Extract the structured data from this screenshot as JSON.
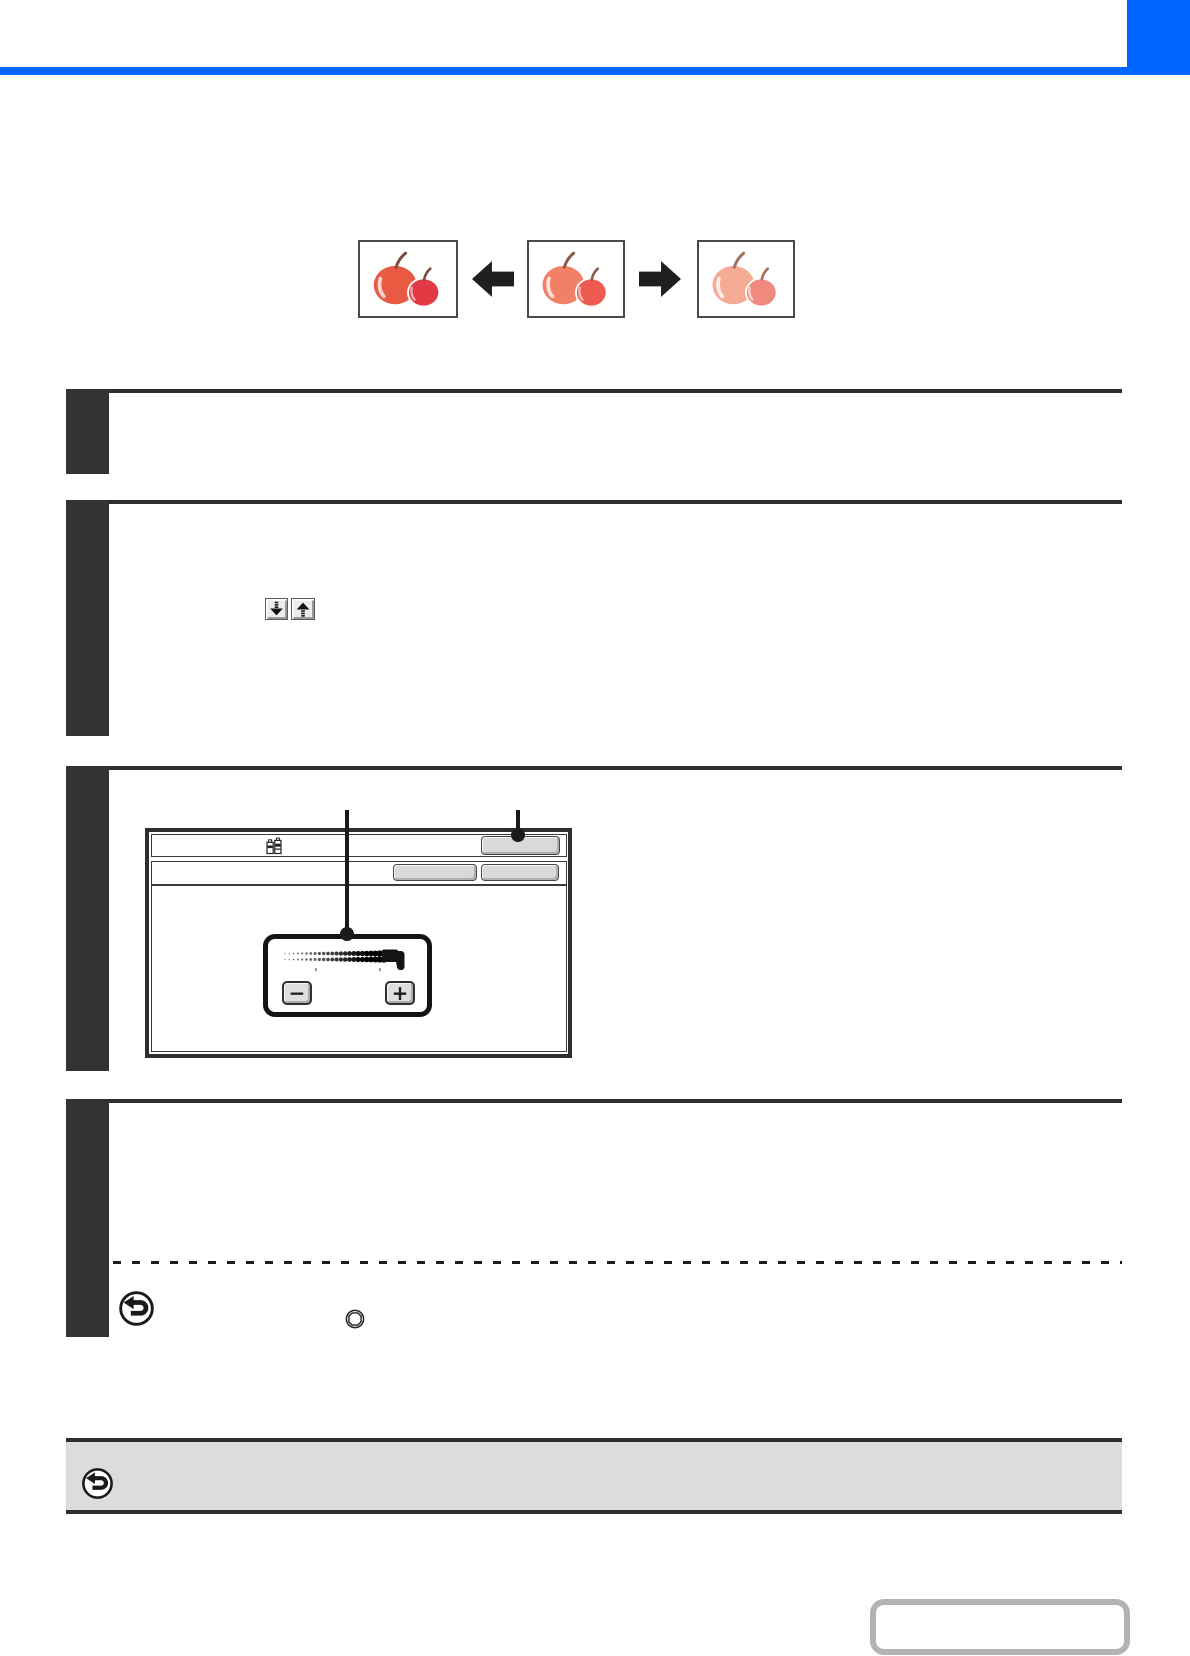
{
  "page": {
    "accent_blue": "#0066ff",
    "rule_dark": "#2e2e2e",
    "note_bar_bg": "#dcdcdc"
  },
  "illustration": {
    "name": "copy-intensity-comparison",
    "arrow_color": "#1f1f1f",
    "frames": [
      {
        "id": "stronger-copy",
        "big_apple": "#e85a41",
        "small_apple": "#e23a44",
        "stem": "#7f4c44",
        "highlight": "rgba(255,255,255,0.75)"
      },
      {
        "id": "original",
        "big_apple": "#f28069",
        "small_apple": "#ed5a52",
        "stem": "#8d574d",
        "highlight": "rgba(255,255,255,0.75)"
      },
      {
        "id": "lighter-copy",
        "big_apple": "#f5ab93",
        "small_apple": "#f08a7f",
        "stem": "#a3705f",
        "highlight": "rgba(255,255,255,0.8)"
      }
    ]
  },
  "steps": [
    {
      "index": "1"
    },
    {
      "index": "2"
    },
    {
      "index": "3"
    },
    {
      "index": "4"
    }
  ],
  "step2": {
    "keys": [
      {
        "icon": "scroll-down-key-icon"
      },
      {
        "icon": "scroll-up-key-icon"
      }
    ]
  },
  "screen": {
    "status_icon": "toner-indicator-icon",
    "header_key": {
      "label": ""
    },
    "row_keys": [
      {
        "label": ""
      },
      {
        "label": ""
      }
    ],
    "intensity_panel": {
      "scale_icon": "halftone-gradient-scale",
      "minus_key": "−",
      "plus_key": "+"
    }
  },
  "step4": {
    "icons": [
      {
        "id": "back-arrow-icon"
      },
      {
        "id": "stop-key-icon"
      }
    ]
  },
  "note_bar": {
    "icon": "back-arrow-icon"
  },
  "footer": {
    "page_link_box": ""
  }
}
